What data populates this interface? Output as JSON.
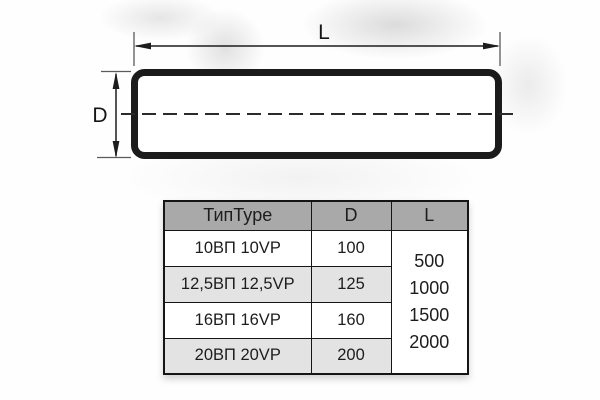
{
  "drawing": {
    "length_label": "L",
    "diameter_label": "D"
  },
  "table": {
    "headers": {
      "type": "ТипType",
      "d": "D",
      "l": "L"
    },
    "rows": [
      {
        "type": "10ВП 10VP",
        "d": "100"
      },
      {
        "type": "12,5ВП 12,5VP",
        "d": "125"
      },
      {
        "type": "16ВП 16VP",
        "d": "160"
      },
      {
        "type": "20ВП 20VP",
        "d": "200"
      }
    ],
    "l_values": [
      "500",
      "1000",
      "1500",
      "2000"
    ]
  },
  "colors": {
    "header_bg": "#a9a9a9",
    "row_alt_bg": "#e3e3e3",
    "table_border": "#151515",
    "drawing_line": "#1b1b1b"
  }
}
